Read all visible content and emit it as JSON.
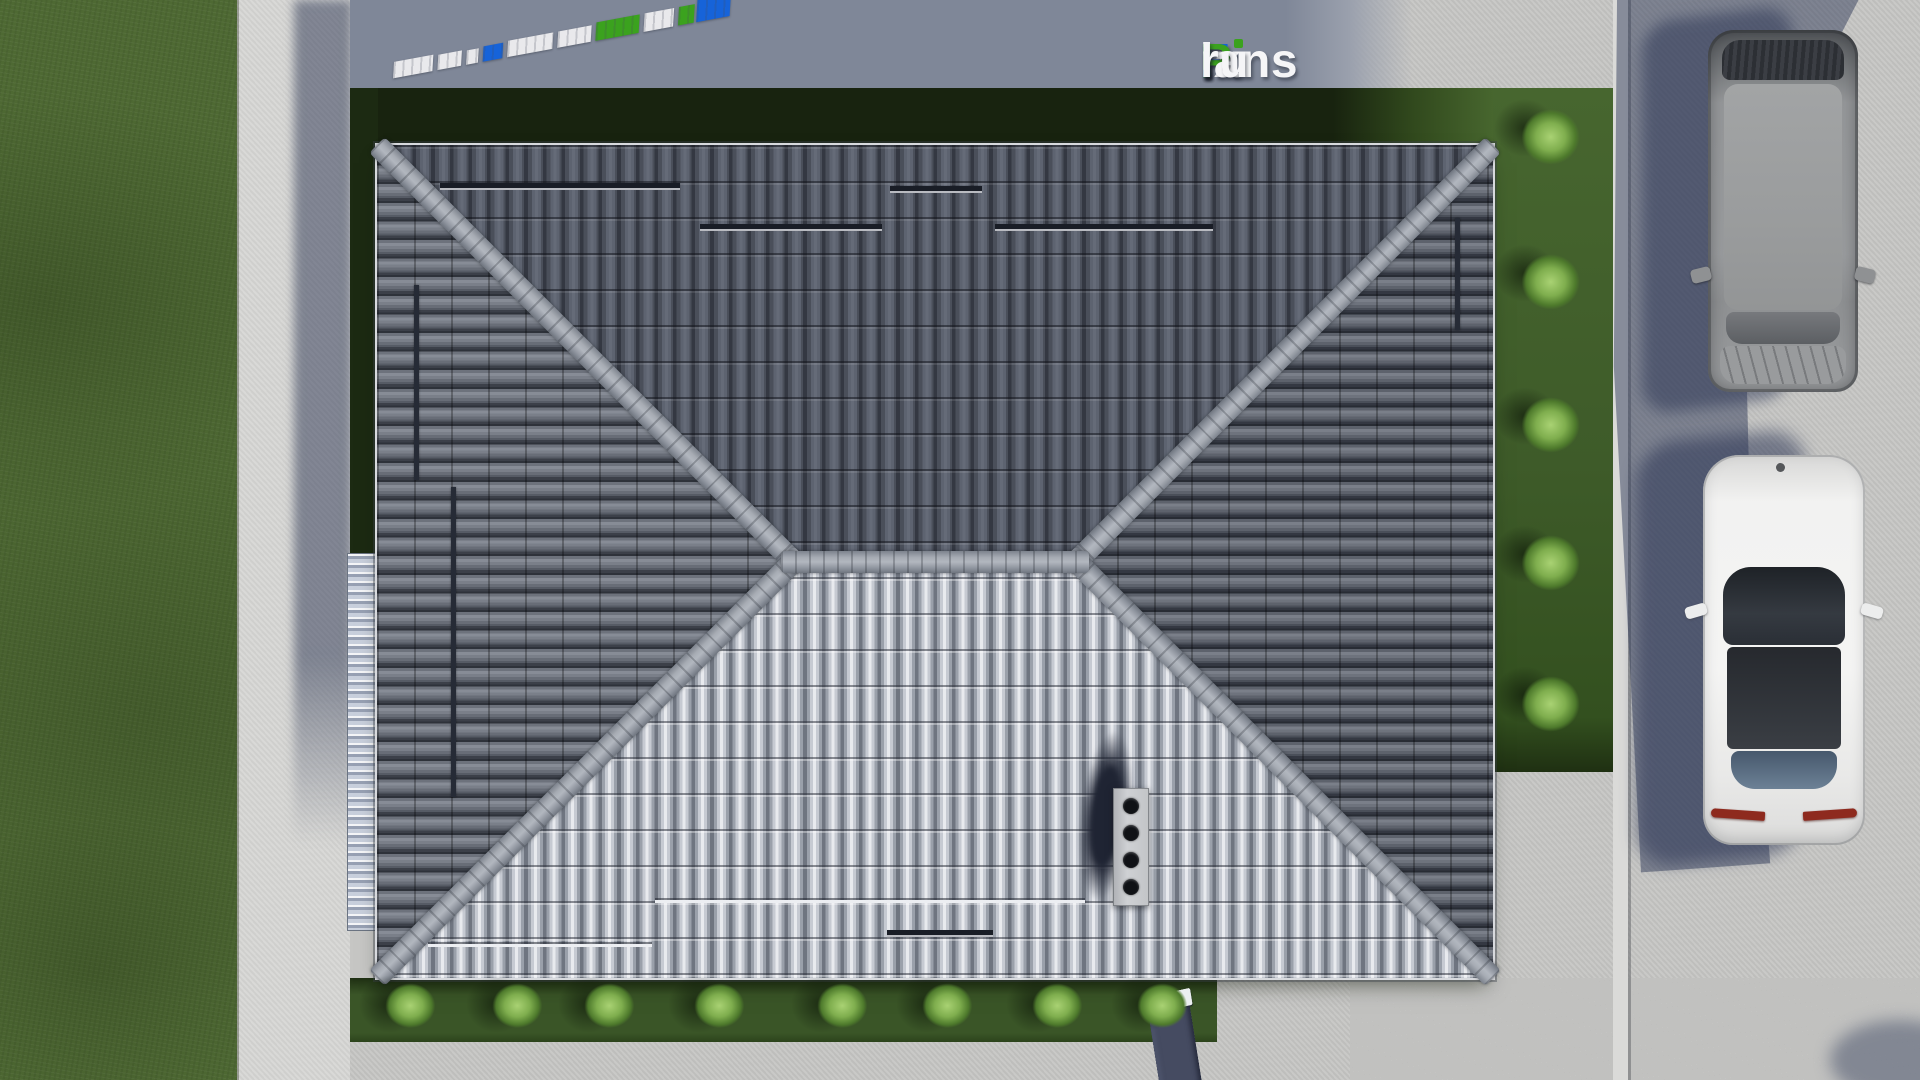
{
  "brand": {
    "text": "FixPlans.ru",
    "parts": [
      {
        "t": "F",
        "c": "blue"
      },
      {
        "t": "ix",
        "c": "white"
      },
      {
        "t": "P",
        "c": "green"
      },
      {
        "t": "lans",
        "c": "white"
      },
      {
        "t": ".",
        "c": "blue"
      },
      {
        "t": "ru",
        "c": "white"
      }
    ],
    "colors": {
      "blue": "#1663d9",
      "green": "#3ba21e",
      "white": "#f5f5f7"
    }
  },
  "watermarks": {
    "top": {
      "text": "FixPlans.ru",
      "style": "flat perspective on pavement",
      "blocks": [
        {
          "w": 40,
          "h": 16,
          "c": "#e9e9ec"
        },
        {
          "w": 24,
          "h": 15,
          "c": "#e9e9ec"
        },
        {
          "w": 12,
          "h": 14,
          "c": "#e9e9ec"
        },
        {
          "w": 20,
          "h": 15,
          "c": "#1663d9"
        },
        {
          "w": 46,
          "h": 16,
          "c": "#e9e9ec"
        },
        {
          "w": 34,
          "h": 16,
          "c": "#e9e9ec"
        },
        {
          "w": 44,
          "h": 18,
          "c": "#3ba21e"
        },
        {
          "w": 30,
          "h": 18,
          "c": "#e9e9ec"
        },
        {
          "w": 16,
          "h": 18,
          "c": "#3ba21e"
        },
        {
          "w": 34,
          "h": 38,
          "c": "#1663d9"
        }
      ]
    },
    "bottom": {
      "text": "FixPlans.ru",
      "visible_fragment": "lans.ru",
      "letters": [
        {
          "t": "l",
          "w": 22,
          "cap": "#eceff1"
        },
        {
          "t": "a",
          "w": 42,
          "cap": "#eceff1"
        },
        {
          "t": "n",
          "w": 42,
          "cap": "#eceff1"
        },
        {
          "t": "s",
          "w": 38,
          "cap": "#eceff1"
        },
        {
          "t": ".",
          "w": 20,
          "cap": "#2f9ce8"
        },
        {
          "t": "r",
          "w": 34,
          "cap": "#eceff1"
        },
        {
          "t": "u",
          "w": 42,
          "cap": "#eceff1"
        }
      ]
    }
  },
  "scene": {
    "type": "3d-render-top-view",
    "subject": "hip-roof house seen from directly above, with lawn, glass canopy, garden bushes, driveway and two parked cars",
    "palette": {
      "lawn": "#4e6933",
      "lot_grass": "#3e5b29",
      "lot_grass_shadow": "#18230f",
      "garden": "#3a5527",
      "pavement": "#c6c6c4",
      "pavement_shadow": "#7f8798",
      "walkway": "#d7d7d5",
      "sidewalk": "#dadad8",
      "roof_north": "#4c515c",
      "roof_south": "#c6cad2",
      "roof_side": "#6a6e78",
      "ridge_cap": "#9aa0a8",
      "chimney": "#c6c8cb",
      "cast_shadow": "#2c3656",
      "suv_body": "#97999b",
      "sedan_body": "#f2f2f1",
      "taillight": "#8e2a1e"
    },
    "garden_bush_y": 1008,
    "garden_bushes": [
      413,
      520,
      612,
      722,
      845,
      950,
      1060,
      1165
    ],
    "right_bush_x": 1512,
    "right_bushes": [
      140,
      285,
      428,
      566,
      707
    ],
    "rails_h": [
      {
        "x": 440,
        "y": 183,
        "w": 240,
        "v": "dark"
      },
      {
        "x": 890,
        "y": 186,
        "w": 92,
        "v": "dark"
      },
      {
        "x": 700,
        "y": 224,
        "w": 182,
        "v": "dark"
      },
      {
        "x": 995,
        "y": 224,
        "w": 218,
        "v": "dark"
      },
      {
        "x": 428,
        "y": 942,
        "w": 224,
        "v": "light"
      },
      {
        "x": 655,
        "y": 898,
        "w": 430,
        "v": "light"
      },
      {
        "x": 887,
        "y": 930,
        "w": 106,
        "v": "dark"
      }
    ],
    "rails_v": [
      {
        "x": 414,
        "y": 285,
        "h": 195
      },
      {
        "x": 451,
        "y": 487,
        "h": 310
      },
      {
        "x": 1455,
        "y": 218,
        "h": 112
      }
    ],
    "chimney": {
      "holes": 4
    },
    "vehicles": [
      {
        "kind": "suv",
        "color": "gray"
      },
      {
        "kind": "sedan",
        "color": "white"
      }
    ]
  }
}
